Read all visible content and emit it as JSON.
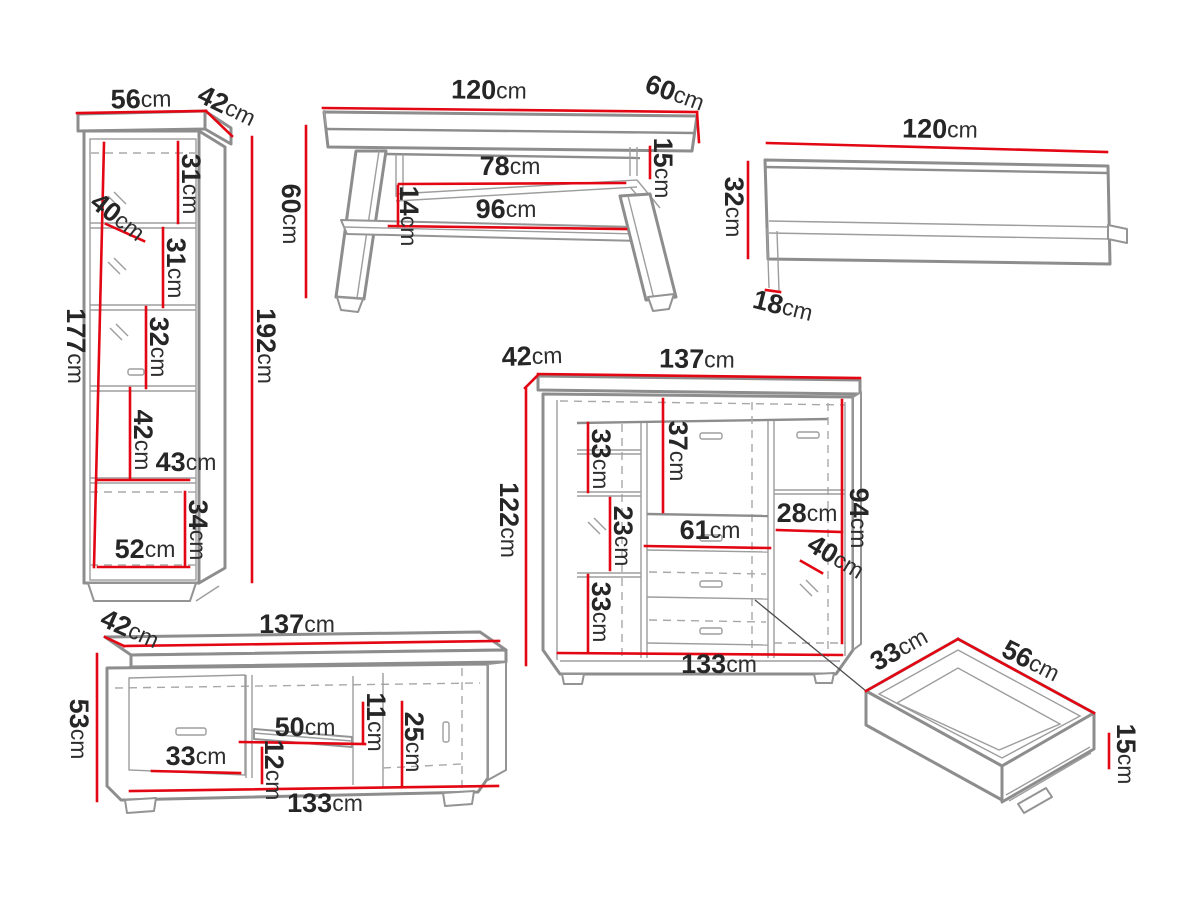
{
  "unit": "cm",
  "colors": {
    "dimension_red": "#e30613",
    "outline_gray": "#8d8d8d",
    "text_dark": "#262626",
    "background": "#ffffff"
  },
  "pieces": {
    "cabinet": {
      "width": "56",
      "depth": "42",
      "height": "192",
      "interior_height": "177",
      "interior_depth": "40",
      "section1": "31",
      "section2": "31",
      "section3": "32",
      "section4": "42",
      "interior_width": "43",
      "bottom_section": "34",
      "bottom_width": "52"
    },
    "table": {
      "width": "120",
      "depth": "60",
      "height": "60",
      "top_gap": "15",
      "upper_shelf_width": "78",
      "lower_shelf_width": "96",
      "shelf_gap": "14"
    },
    "wallshelf": {
      "width": "120",
      "height": "32",
      "depth": "18"
    },
    "sideboard": {
      "depth": "42",
      "width": "137",
      "height": "122",
      "left_top_section": "33",
      "center_top_section": "37",
      "left_middle_section": "23",
      "niche_width": "61",
      "right_shelf_section": "28",
      "right_depth": "40",
      "left_bottom_section": "33",
      "interior_height": "94",
      "interior_width": "133"
    },
    "tvstand": {
      "depth": "42",
      "width": "137",
      "height": "53",
      "left_door_width": "33",
      "shelf_width": "50",
      "shelf_gap_top": "11",
      "right_section_height": "25",
      "shelf_gap_bottom": "12",
      "interior_width": "133"
    },
    "drawer": {
      "depth": "33",
      "width": "56",
      "height": "15"
    }
  }
}
